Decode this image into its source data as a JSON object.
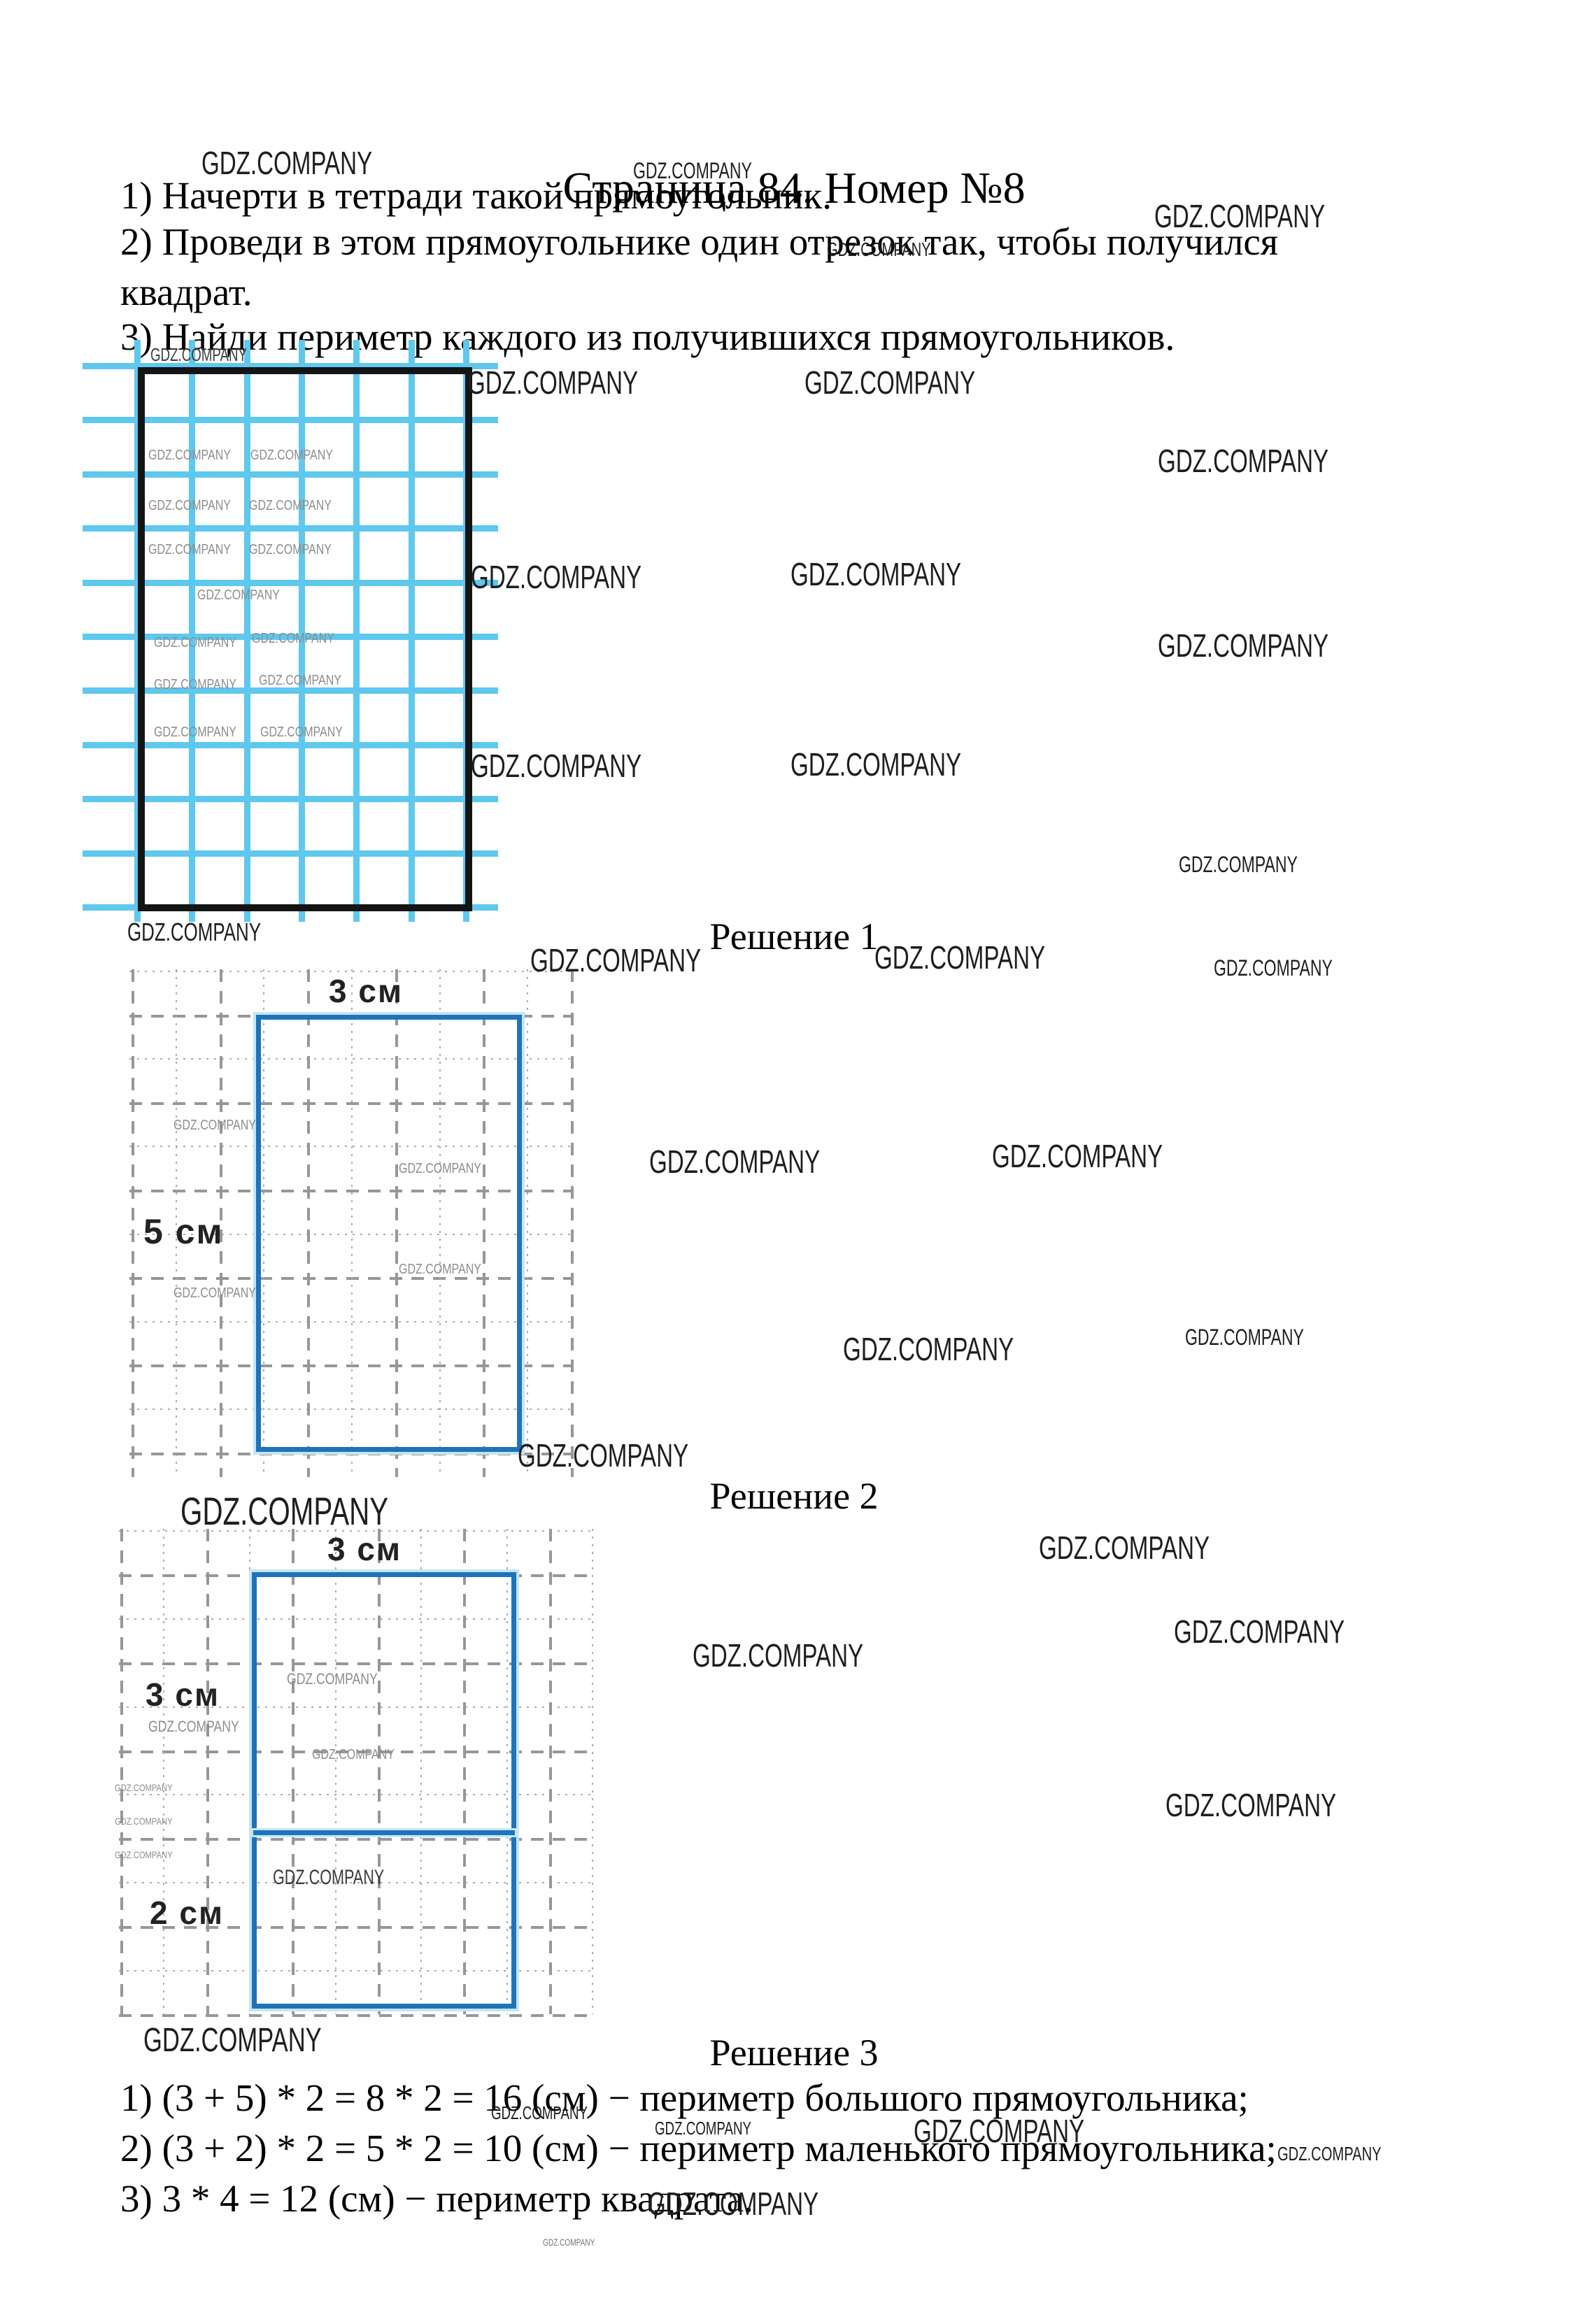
{
  "page": {
    "title": "Страница 84. Номер №8"
  },
  "task": {
    "lines": [
      "1) Начерти в тетради такой прямоугольник.",
      "2) Проведи в этом прямоугольнике один отрезок так, чтобы получился",
      "квадрат.",
      "3) Найди периметр каждого из получившихся прямоугольников."
    ]
  },
  "watermark": {
    "text": "GDZ.COMPANY"
  },
  "solution1": {
    "heading": "Решение 1",
    "width_label": "3 см",
    "height_label": "5 см"
  },
  "solution2": {
    "heading": "Решение 2",
    "width_label": "3 см",
    "square_label": "3 см",
    "rect_label": "2 см"
  },
  "solution3": {
    "heading": "Решение 3",
    "lines": [
      "1) (3 + 5) * 2 = 8 * 2 = 16 (см) − периметр большого прямоугольника;",
      "2) (3 + 2) * 2 = 5 * 2 = 10 (см) − периметр маленького прямоугольника;",
      "3) 3 * 4 = 12 (см) − периметр квадрата."
    ]
  },
  "colors": {
    "graph_blue": "#5ec8ee",
    "figure_black": "#141414",
    "solution_blue": "#1e74ba",
    "dash_gray": "#979797"
  }
}
